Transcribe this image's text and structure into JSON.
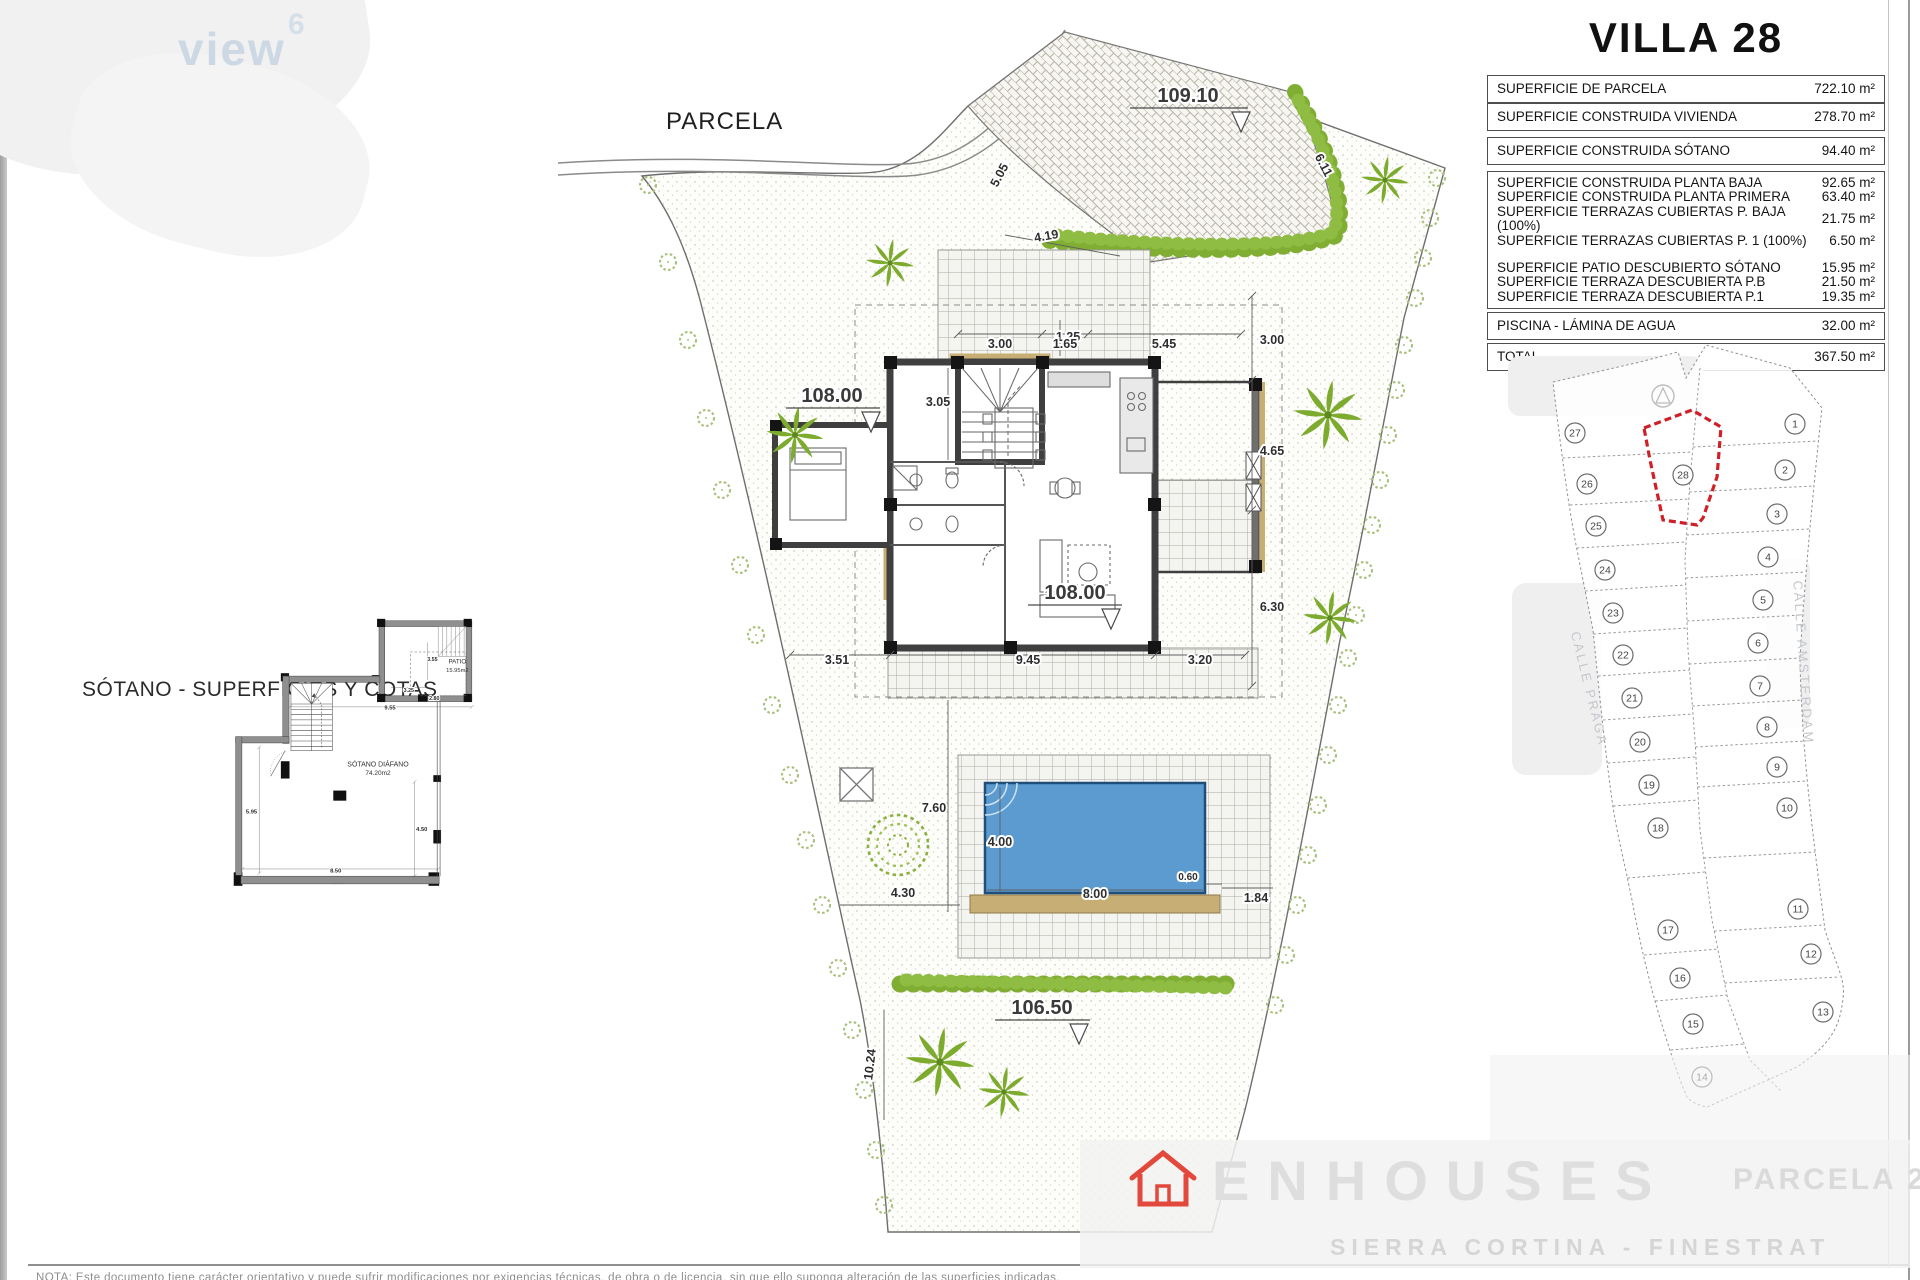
{
  "watermarks": {
    "top_left": {
      "word": "view",
      "superscript": "6"
    },
    "bottom": {
      "brand": "ENHOUSES",
      "plot": "PARCELA 28",
      "location": "SIERRA CORTINA - FINESTRAT"
    },
    "footer_note": "NOTA: Este documento tiene carácter orientativo y puede sufrir modificaciones por exigencias técnicas, de obra o de licencia, sin que ello suponga alteración de las superficies indicadas."
  },
  "basement": {
    "title": "SÓTANO - SUPERFICIES Y COTAS",
    "patio_name": "PATIO",
    "patio_area": "15.95m2",
    "room_name": "SÓTANO DIÁFANO",
    "room_area": "74.20m2",
    "dims": [
      "2.80",
      "9.55",
      "3.55",
      "3.25",
      "5.95",
      "4.50",
      "8.50"
    ]
  },
  "site": {
    "title": "PARCELA",
    "elevations": [
      "109.10",
      "108.00",
      "108.00",
      "106.50"
    ],
    "dims": [
      "5.05",
      "6.11",
      "4.19",
      "1.25",
      "3.00",
      "1.65",
      "5.45",
      "3.05",
      "3.00",
      "4.65",
      "6.30",
      "3.51",
      "9.45",
      "3.20",
      "7.60",
      "4.00",
      "8.00",
      "0.60",
      "1.84",
      "4.30",
      "10.24"
    ]
  },
  "villa_table": {
    "title": "VILLA 28",
    "groups": [
      [
        {
          "label": "SUPERFICIE DE PARCELA",
          "value": "722.10 m²"
        }
      ],
      [
        {
          "label": "SUPERFICIE CONSTRUIDA VIVIENDA",
          "value": "278.70 m²"
        }
      ],
      [
        {
          "label": "SUPERFICIE CONSTRUIDA SÓTANO",
          "value": "94.40 m²"
        }
      ],
      [
        {
          "label": "SUPERFICIE CONSTRUIDA PLANTA BAJA",
          "value": "92.65 m²"
        },
        {
          "label": "SUPERFICIE CONSTRUIDA PLANTA PRIMERA",
          "value": "63.40 m²"
        },
        {
          "label": "SUPERFICIE TERRAZAS CUBIERTAS P. BAJA (100%)",
          "value": "21.75 m²"
        },
        {
          "label": "SUPERFICIE TERRAZAS CUBIERTAS P. 1 (100%)",
          "value": "6.50 m²"
        },
        {
          "label": "",
          "value": ""
        },
        {
          "label": "SUPERFICIE PATIO DESCUBIERTO SÓTANO",
          "value": "15.95 m²"
        },
        {
          "label": "SUPERFICIE TERRAZA DESCUBIERTA P.B",
          "value": "21.50 m²"
        },
        {
          "label": "SUPERFICIE TERRAZA DESCUBIERTA P.1",
          "value": "19.35 m²"
        }
      ],
      [
        {
          "label": "PISCINA - LÁMINA DE AGUA",
          "value": "32.00 m²"
        }
      ],
      [
        {
          "label": "TOTAL",
          "value": "367.50 m²"
        }
      ]
    ]
  },
  "plot_map": {
    "highlight_parcel": "28",
    "left_parcels": [
      "27",
      "26",
      "25",
      "24",
      "23",
      "22",
      "21",
      "20",
      "19",
      "18",
      "17",
      "16",
      "15",
      "14"
    ],
    "right_parcels": [
      "1",
      "2",
      "3",
      "4",
      "5",
      "6",
      "7",
      "8",
      "9",
      "10",
      "11",
      "12",
      "13"
    ],
    "streets": [
      "CALLE PRAGA",
      "CALLE AMSTERDAM"
    ]
  },
  "colors": {
    "pool_water": "#5b9bd0",
    "tan_wall": "#c7ae74",
    "vegetation": "#7cab2e",
    "highlight_red": "#cf2027"
  }
}
